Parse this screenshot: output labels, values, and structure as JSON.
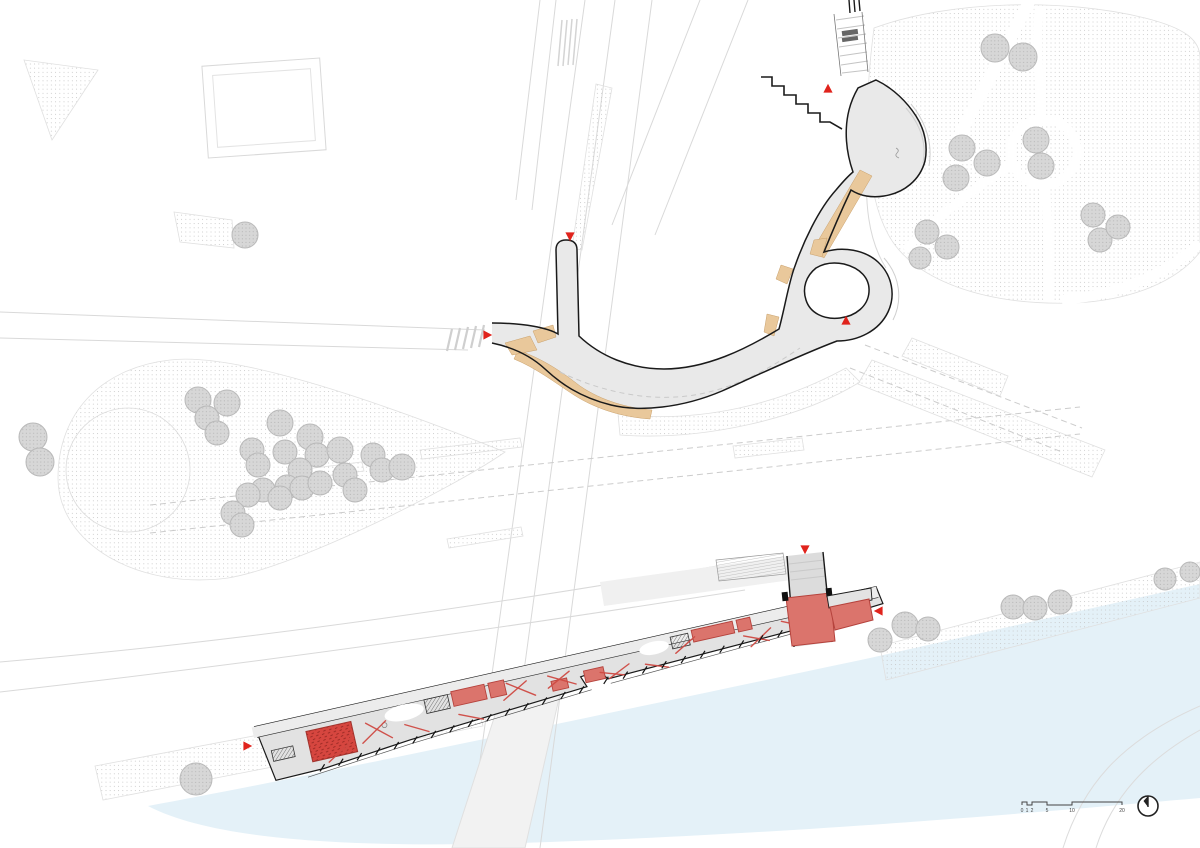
{
  "plan": {
    "colors": {
      "water": "#e4f1f8",
      "path_fill": "#e9e9e9",
      "deck_fill": "#e2e2e2",
      "walkway_fill": "#ececec",
      "tan": "#e9c89b",
      "tan_stroke": "#c9a06b",
      "red_fill": "#db746c",
      "red_stroke": "#b5423c",
      "red_dense": "#d6463f",
      "red_line": "#cf4a43",
      "marker": "#e0231c",
      "outline": "#1a1a1a",
      "context": "#d9d9d9",
      "tree_stroke": "#b9b9b9",
      "stipple_dot": "#c4c4c4"
    },
    "scale_bar": {
      "labels": [
        "0",
        "1",
        "2",
        "5",
        "10",
        "20"
      ]
    },
    "north_arrow_icon": "compass-north-icon",
    "entry_marker_icon": "red-triangle-arrow",
    "entry_markers": [
      {
        "x": 570,
        "y": 236,
        "dir": "down"
      },
      {
        "x": 487,
        "y": 335,
        "dir": "right"
      },
      {
        "x": 846,
        "y": 321,
        "dir": "up"
      },
      {
        "x": 828,
        "y": 89,
        "dir": "up"
      },
      {
        "x": 805,
        "y": 549,
        "dir": "down"
      },
      {
        "x": 879,
        "y": 611,
        "dir": "left"
      },
      {
        "x": 247,
        "y": 746,
        "dir": "right"
      }
    ],
    "trees": {
      "park_left": [
        [
          198,
          400,
          13
        ],
        [
          227,
          403,
          13
        ],
        [
          207,
          418,
          12
        ],
        [
          217,
          433,
          12
        ],
        [
          280,
          423,
          13
        ],
        [
          285,
          452,
          12
        ],
        [
          252,
          450,
          12
        ],
        [
          258,
          465,
          12
        ],
        [
          310,
          437,
          13
        ],
        [
          317,
          455,
          12
        ],
        [
          300,
          470,
          12
        ],
        [
          287,
          487,
          12
        ],
        [
          263,
          490,
          12
        ],
        [
          248,
          495,
          12
        ],
        [
          233,
          513,
          12
        ],
        [
          242,
          525,
          12
        ],
        [
          280,
          498,
          12
        ],
        [
          302,
          488,
          12
        ],
        [
          320,
          483,
          12
        ],
        [
          340,
          450,
          13
        ],
        [
          345,
          475,
          12
        ],
        [
          355,
          490,
          12
        ],
        [
          373,
          455,
          12
        ],
        [
          382,
          470,
          12
        ],
        [
          402,
          467,
          13
        ],
        [
          33,
          437,
          14
        ],
        [
          40,
          462,
          14
        ]
      ],
      "park_top_right": [
        [
          995,
          48,
          14
        ],
        [
          1023,
          57,
          14
        ],
        [
          962,
          148,
          13
        ],
        [
          987,
          163,
          13
        ],
        [
          956,
          178,
          13
        ],
        [
          927,
          232,
          12
        ],
        [
          947,
          247,
          12
        ],
        [
          920,
          258,
          11
        ],
        [
          1093,
          215,
          12
        ],
        [
          1100,
          240,
          12
        ],
        [
          1118,
          227,
          12
        ],
        [
          1036,
          140,
          13
        ],
        [
          1041,
          166,
          13
        ]
      ],
      "riverbank": [
        [
          880,
          640,
          12
        ],
        [
          905,
          625,
          13
        ],
        [
          928,
          629,
          12
        ],
        [
          1013,
          607,
          12
        ],
        [
          1035,
          608,
          12
        ],
        [
          1060,
          602,
          12
        ],
        [
          1165,
          579,
          11
        ],
        [
          1190,
          572,
          10
        ]
      ],
      "singles": [
        [
          245,
          235,
          13
        ],
        [
          196,
          779,
          16
        ]
      ]
    },
    "building": {
      "red_boxes": [
        [
          202,
          -6,
          34,
          15
        ],
        [
          240,
          -6,
          16,
          15
        ],
        [
          302,
          6,
          16,
          10
        ],
        [
          336,
          3,
          20,
          12
        ],
        [
          450,
          -13,
          42,
          12
        ],
        [
          496,
          -13,
          14,
          12
        ]
      ],
      "red_scatter": [
        [
          105,
          25,
          132,
          8
        ],
        [
          112,
          6,
          135,
          26
        ],
        [
          150,
          16,
          172,
          28
        ],
        [
          96,
          14,
          86,
          30
        ],
        [
          252,
          14,
          278,
          0
        ],
        [
          258,
          -2,
          284,
          16
        ],
        [
          298,
          12,
          322,
          0
        ],
        [
          300,
          0,
          326,
          14
        ],
        [
          352,
          8,
          376,
          16
        ],
        [
          360,
          16,
          382,
          6
        ],
        [
          398,
          10,
          420,
          18
        ],
        [
          430,
          6,
          452,
          -6
        ],
        [
          500,
          4,
          524,
          14
        ],
        [
          505,
          16,
          528,
          2
        ],
        [
          540,
          -2,
          566,
          10
        ],
        [
          546,
          12,
          570,
          -4
        ],
        [
          586,
          -12,
          612,
          -2
        ],
        [
          592,
          0,
          618,
          -12
        ],
        [
          68,
          36,
          88,
          24
        ],
        [
          205,
          18,
          228,
          28
        ],
        [
          572,
          -2,
          598,
          -12
        ]
      ],
      "stair_runs": [
        {
          "x1": 60,
          "y1": 40,
          "x2": 330,
          "y2": 21,
          "n": 15
        },
        {
          "x1": 356,
          "y1": 17,
          "x2": 556,
          "y2": 9,
          "n": 11
        }
      ]
    }
  }
}
